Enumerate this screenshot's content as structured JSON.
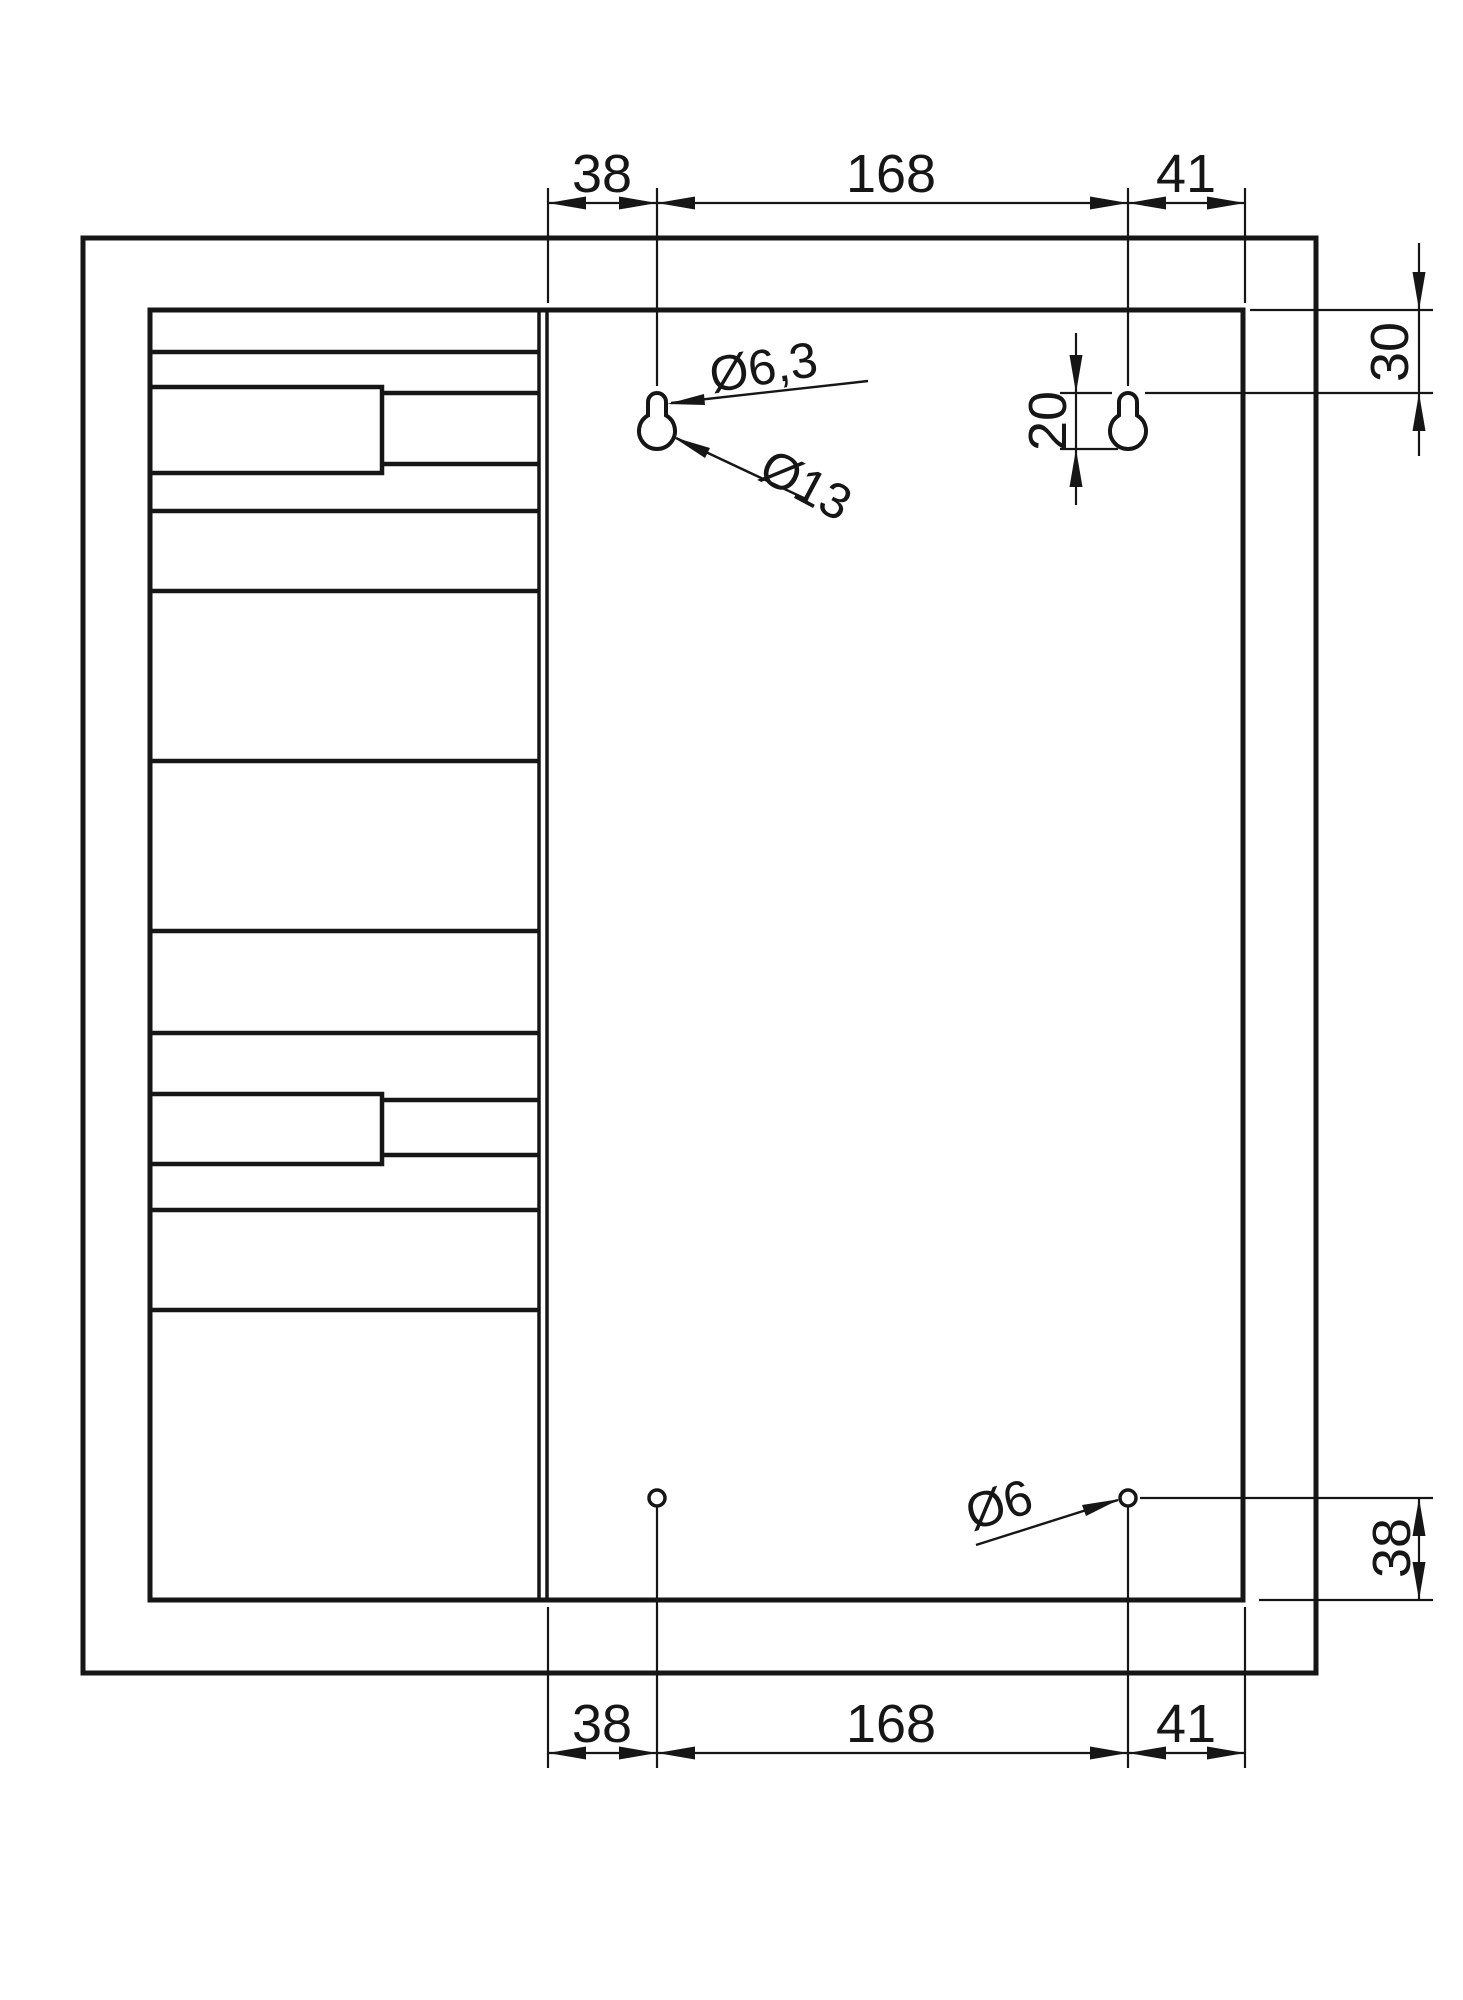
{
  "page": {
    "background": "#ffffff",
    "line_color": "#161616",
    "type_note": "technical mounting drawing"
  },
  "drawing": {
    "dim_top": {
      "left": "38",
      "middle": "168",
      "right": "41"
    },
    "dim_bottom": {
      "left": "38",
      "middle": "168",
      "right": "41"
    },
    "dim_right": {
      "top_offset": "30",
      "keyhole_length": "20",
      "bottom_offset": "38"
    },
    "callouts": {
      "keyhole_slot_diameter": "Ø6,3",
      "keyhole_circle_diameter": "Ø13",
      "bottom_hole_diameter": "Ø6"
    }
  }
}
